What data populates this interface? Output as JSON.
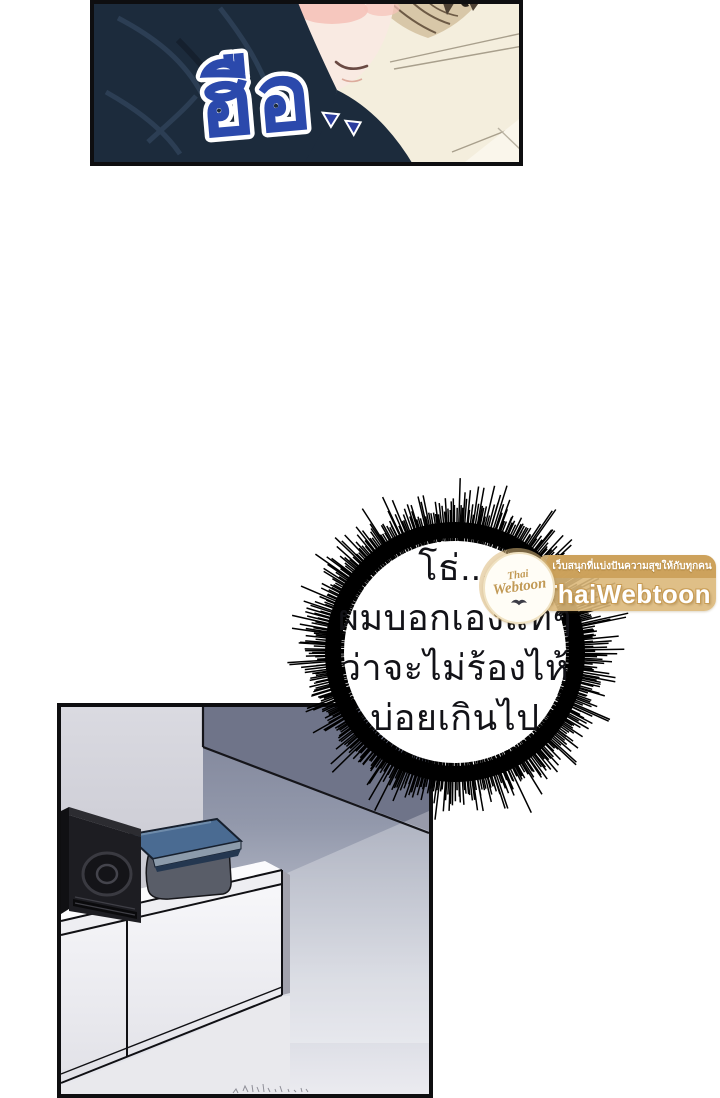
{
  "page": {
    "background": "#ffffff"
  },
  "top_panel": {
    "sfx_text": "ฮือ",
    "sfx_marks": "▾▾",
    "sfx_color": "#2b49ac"
  },
  "speech_bubble": {
    "lines": [
      "โธ่...",
      "ผมบอกเองแท้ๆ",
      "ว่าจะไม่ร้องไห้",
      "บ่อยเกินไป"
    ],
    "text_color": "#121217"
  },
  "watermark": {
    "badge_script_top": "Thai",
    "badge_script_bottom": "Webtoon",
    "tagline": "เว็บสนุกที่แบ่งปันความสุขให้กับทุกคน",
    "brand": "ThaiWebtoon",
    "banner_color": "#dbb97c",
    "band_color": "#cba05a",
    "text_color": "#ffffff",
    "script_color": "#c29a55"
  },
  "palette": {
    "panel_border": "#0e0e10",
    "hair_navy": "#1c2b3c",
    "hair_navy_light": "#2d4056",
    "skin": "#f9eae2",
    "blush": "#f5c3ba",
    "pillow_cream": "#f4eedd",
    "wall_left": "#d6d6dd",
    "wall_right": "#868ba0",
    "floor": "#e9e9ed",
    "cabinet_white": "#f4f4f7",
    "speaker_black": "#1d1d22",
    "book_blue": "#4a6b92",
    "book_case_grey": "#595d68"
  }
}
